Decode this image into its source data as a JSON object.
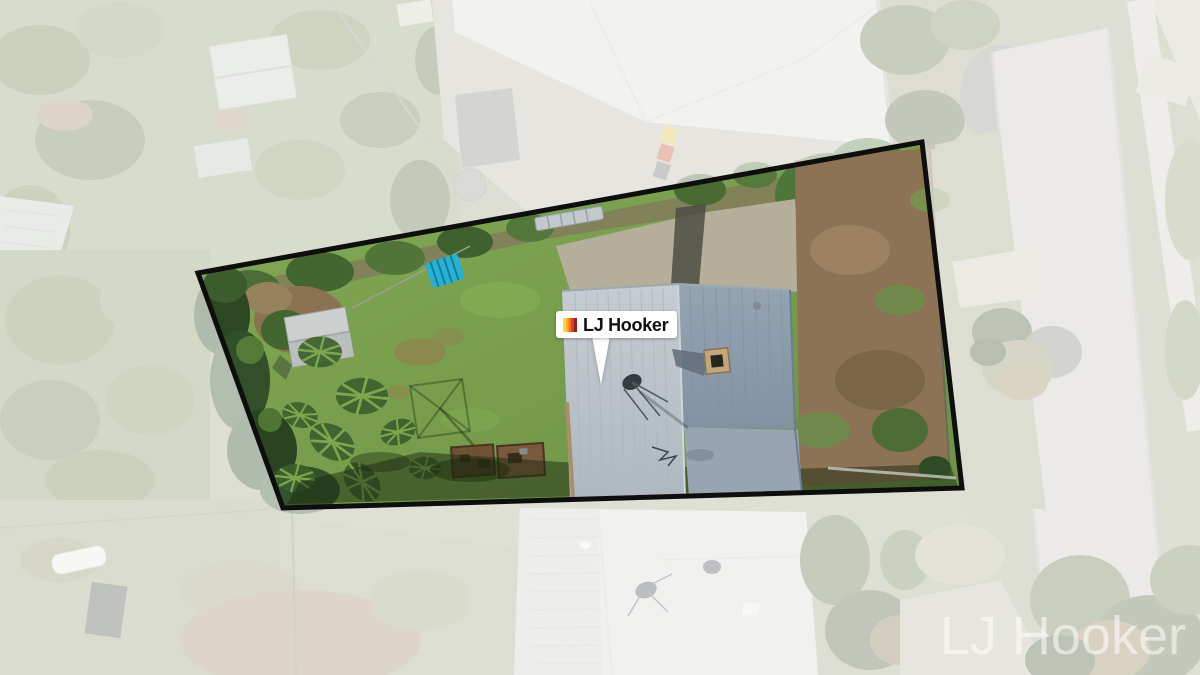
{
  "page": {
    "type": "real-estate aerial drone photograph with property boundary overlay",
    "width_px": 1200,
    "height_px": 675
  },
  "pin": {
    "label": "LJ Hooker",
    "background": "#ffffff",
    "text_color": "#111111",
    "logo_colors": [
      "#FFD44A",
      "#FFB41E",
      "#F4701F",
      "#E03A2C",
      "#8E1F1F"
    ]
  },
  "watermark": {
    "text": "LJ Hooker",
    "color": "rgba(255,255,255,0.55)"
  },
  "boundary": {
    "points": "198,273 922,142 962,488 283,508",
    "stroke": "#0e0e0e",
    "stroke_width": 5,
    "outside_fade": "rgba(255,255,255,0.63)"
  },
  "scene_palette": {
    "lawn": "#79a14e",
    "house_roof_left": "#bcc3c9",
    "house_roof_right": "#8c9cab",
    "dirt_yard": "#8d7355",
    "road": "#c9c7c2",
    "patio_concrete": "#b5ae9b",
    "neighbor_roof": "#dcdbd4"
  }
}
